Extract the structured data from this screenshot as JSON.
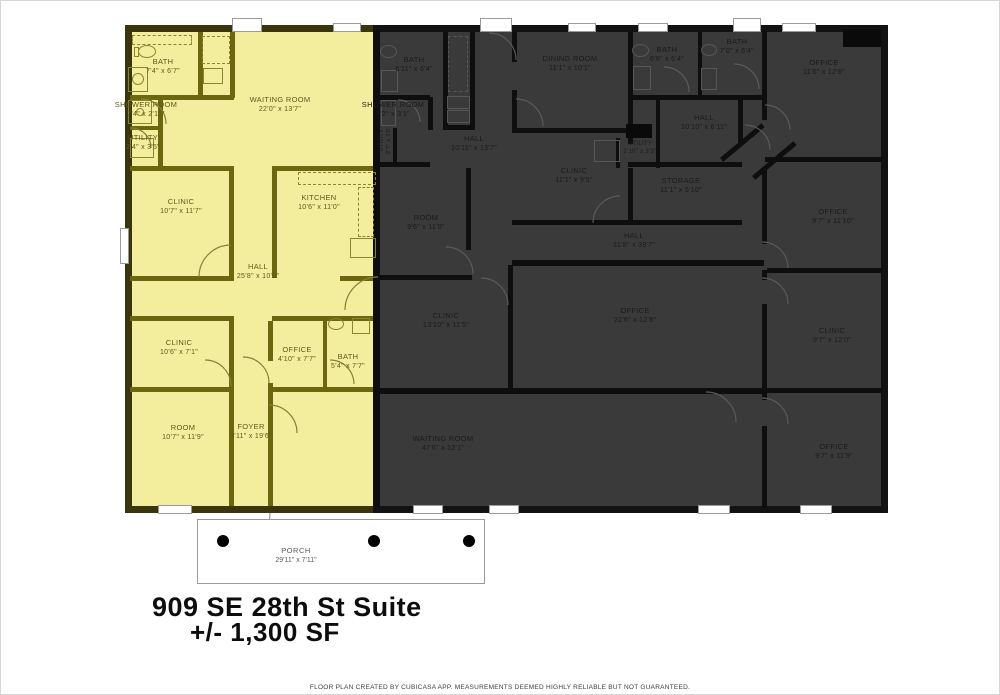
{
  "title": {
    "line1": "909 SE 28th St Suite",
    "line2": "+/- 1,300 SF"
  },
  "footer": "FLOOR PLAN CREATED BY CUBICASA APP. MEASUREMENTS DEEMED HIGHLY RELIABLE BUT NOT GUARANTEED.",
  "porch": {
    "name": "PORCH",
    "dims": "29'11\" x 7'11\""
  },
  "colors": {
    "suite_highlight": "#f3ee9e",
    "suite_wall": "#6c660f",
    "dark_fill": "#3a3a3a",
    "wall": "#0e0e0e",
    "suite_label": "#5c581c",
    "dark_label": "#1a1a1a"
  },
  "suite": {
    "rooms": [
      {
        "name": "BATH",
        "dims": "7'4\" x 6'7\""
      },
      {
        "name": "SHOWER ROOM",
        "dims": "7'4\" x 2'11\""
      },
      {
        "name": "UTILITY",
        "dims": "2'4\" x 3'5\""
      },
      {
        "name": "WAITING ROOM",
        "dims": "22'0\" x 13'7\""
      },
      {
        "name": "CLINIC",
        "dims": "10'7\" x 11'7\""
      },
      {
        "name": "KITCHEN",
        "dims": "10'6\" x 11'0\""
      },
      {
        "name": "HALL",
        "dims": "25'8\" x 10'0\""
      },
      {
        "name": "CLINIC",
        "dims": "10'6\" x 7'1\""
      },
      {
        "name": "OFFICE",
        "dims": "4'10\" x 7'7\""
      },
      {
        "name": "BATH",
        "dims": "5'4\" x 7'7\""
      },
      {
        "name": "ROOM",
        "dims": "10'7\" x 11'9\""
      },
      {
        "name": "FOYER",
        "dims": "3'11\" x 19'6\""
      }
    ]
  },
  "dark": {
    "rooms": [
      {
        "name": "BATH",
        "dims": "6'11\" x 6'4\""
      },
      {
        "name": "SHOWER ROOM",
        "dims": "7'2\" x 3'1\""
      },
      {
        "name": "UTILITY",
        "dims": "2'7\" x 3'6\""
      },
      {
        "name": "HALL",
        "dims": "10'11\" x 13'7\""
      },
      {
        "name": "DINING ROOM",
        "dims": "11'1\" x 10'1\""
      },
      {
        "name": "CLINIC",
        "dims": "11'1\" x 9'5\""
      },
      {
        "name": "BATH",
        "dims": "6'8\" x 6'4\""
      },
      {
        "name": "BATH",
        "dims": "7'0\" x 6'4\""
      },
      {
        "name": "OFFICE",
        "dims": "11'6\" x 12'6\""
      },
      {
        "name": "HALL",
        "dims": "10'10\" x 6'11\""
      },
      {
        "name": "UTILITY",
        "dims": "2'10\" x 3'3\""
      },
      {
        "name": "STORAGE",
        "dims": "11'1\" x 5'10\""
      },
      {
        "name": "ROOM",
        "dims": "9'6\" x 11'0\""
      },
      {
        "name": "HALL",
        "dims": "31'8\" x 39'7\""
      },
      {
        "name": "CLINIC",
        "dims": "13'10\" x 11'5\""
      },
      {
        "name": "OFFICE",
        "dims": "22'6\" x 12'8\""
      },
      {
        "name": "OFFICE",
        "dims": "9'7\" x 11'10\""
      },
      {
        "name": "CLINIC",
        "dims": "9'7\" x 12'0\""
      },
      {
        "name": "OFFICE",
        "dims": "9'7\" x 11'9\""
      },
      {
        "name": "WAITING ROOM",
        "dims": "47'6\" x 12'1\""
      }
    ]
  }
}
